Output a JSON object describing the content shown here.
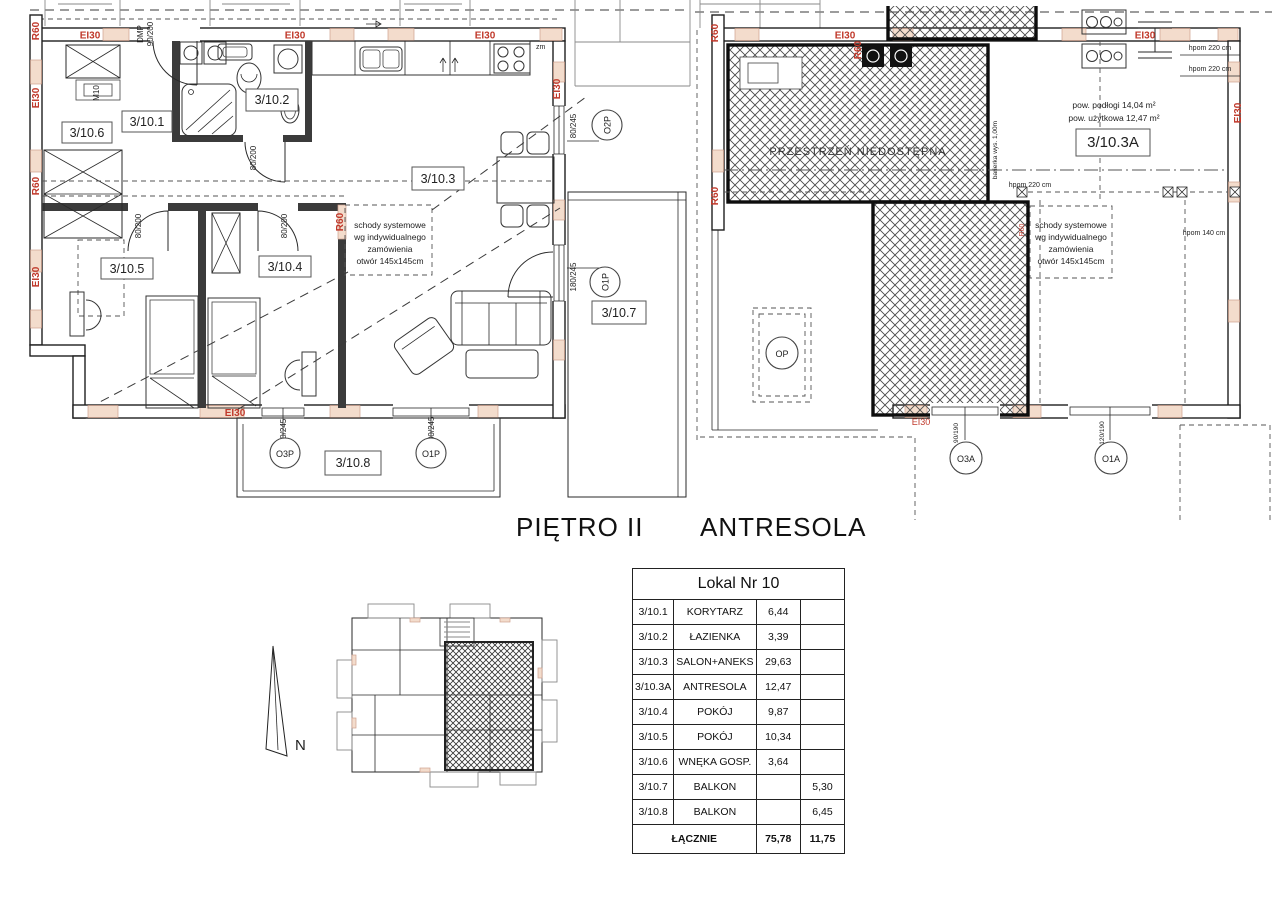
{
  "colors": {
    "fire_label_red": "#c0392b",
    "lintel_fill": "#f3dccc",
    "wall_dark": "#3b3b3b"
  },
  "titles": {
    "floor_plan": "PIĘTRO II",
    "mezzanine_plan": "ANTRESOLA"
  },
  "labels": {
    "ei30": "EI30",
    "r60": "R60",
    "dmp": "DMP",
    "dmp_size": "90/200",
    "m10": "M10",
    "zm": "zm",
    "d80_200": "80/200",
    "d80_245": "80/245",
    "d180_245": "180/245",
    "d90_245": "90/245",
    "d90_190": "90/190",
    "d120_190": "120/190"
  },
  "left_plan": {
    "rooms": {
      "r1": "3/10.1",
      "r2": "3/10.2",
      "r3": "3/10.3",
      "r4": "3/10.4",
      "r5": "3/10.5",
      "r6": "3/10.6",
      "r7": "3/10.7",
      "r8": "3/10.8"
    },
    "windows": {
      "o2p": "O2P",
      "o1p": "O1P",
      "o3p": "O3P"
    },
    "stairs_note": {
      "l1": "schody systemowe",
      "l2": "wg indywidualnego",
      "l3": "zamówienia",
      "l4": "otwór 145x145cm"
    }
  },
  "right_plan": {
    "room": "3/10.3A",
    "inaccessible": "PRZESTRZEŃ NIEDOSTĘPNA",
    "floor_area": "pow. podłogi 14,04 m²",
    "usable_area": "pow. użytkowa 12,47 m²",
    "hpom220": "hpom 220 cm",
    "hpom140": "hpom 140 cm",
    "railing": "barierka wys. 1,00m",
    "windows": {
      "op": "OP",
      "o3a": "O3A",
      "o1a": "O1A"
    }
  },
  "key_plan": {
    "north": "N"
  },
  "area_table": {
    "title": "Lokal Nr 10",
    "rows": [
      {
        "id": "3/10.1",
        "name": "KORYTARZ",
        "area": "6,44",
        "balcony": ""
      },
      {
        "id": "3/10.2",
        "name": "ŁAZIENKA",
        "area": "3,39",
        "balcony": ""
      },
      {
        "id": "3/10.3",
        "name": "SALON+ANEKS",
        "area": "29,63",
        "balcony": ""
      },
      {
        "id": "3/10.3A",
        "name": "ANTRESOLA",
        "area": "12,47",
        "balcony": ""
      },
      {
        "id": "3/10.4",
        "name": "POKÓJ",
        "area": "9,87",
        "balcony": ""
      },
      {
        "id": "3/10.5",
        "name": "POKÓJ",
        "area": "10,34",
        "balcony": ""
      },
      {
        "id": "3/10.6",
        "name": "WNĘKA GOSP.",
        "area": "3,64",
        "balcony": ""
      },
      {
        "id": "3/10.7",
        "name": "BALKON",
        "area": "",
        "balcony": "5,30"
      },
      {
        "id": "3/10.8",
        "name": "BALKON",
        "area": "",
        "balcony": "6,45"
      }
    ],
    "total": {
      "name": "ŁĄCZNIE",
      "area": "75,78",
      "balcony": "11,75"
    }
  }
}
